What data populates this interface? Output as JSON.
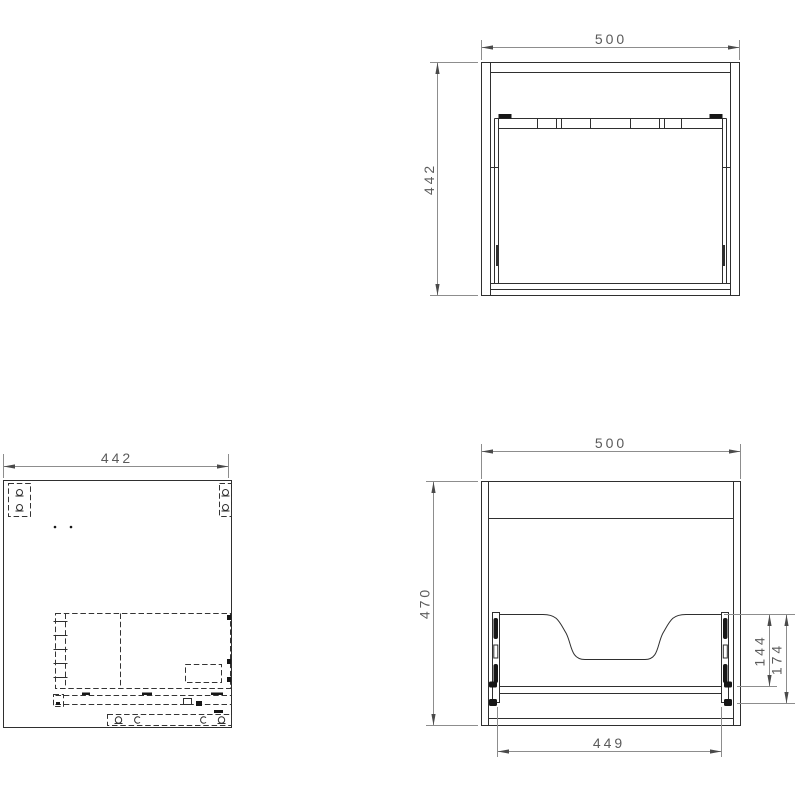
{
  "drawing": {
    "colors": {
      "background": "#ffffff",
      "object_line": "#2f2f2f",
      "hidden_line": "#343434",
      "dimension_line": "#8d8d8d",
      "dimension_text": "#5b5b5b"
    },
    "top_view": {
      "width": "500",
      "depth": "442"
    },
    "side_view": {
      "depth": "442"
    },
    "front_view": {
      "width": "500",
      "height": "470",
      "drawer_width": "449",
      "slide_height": "144",
      "opening_height": "174"
    }
  }
}
